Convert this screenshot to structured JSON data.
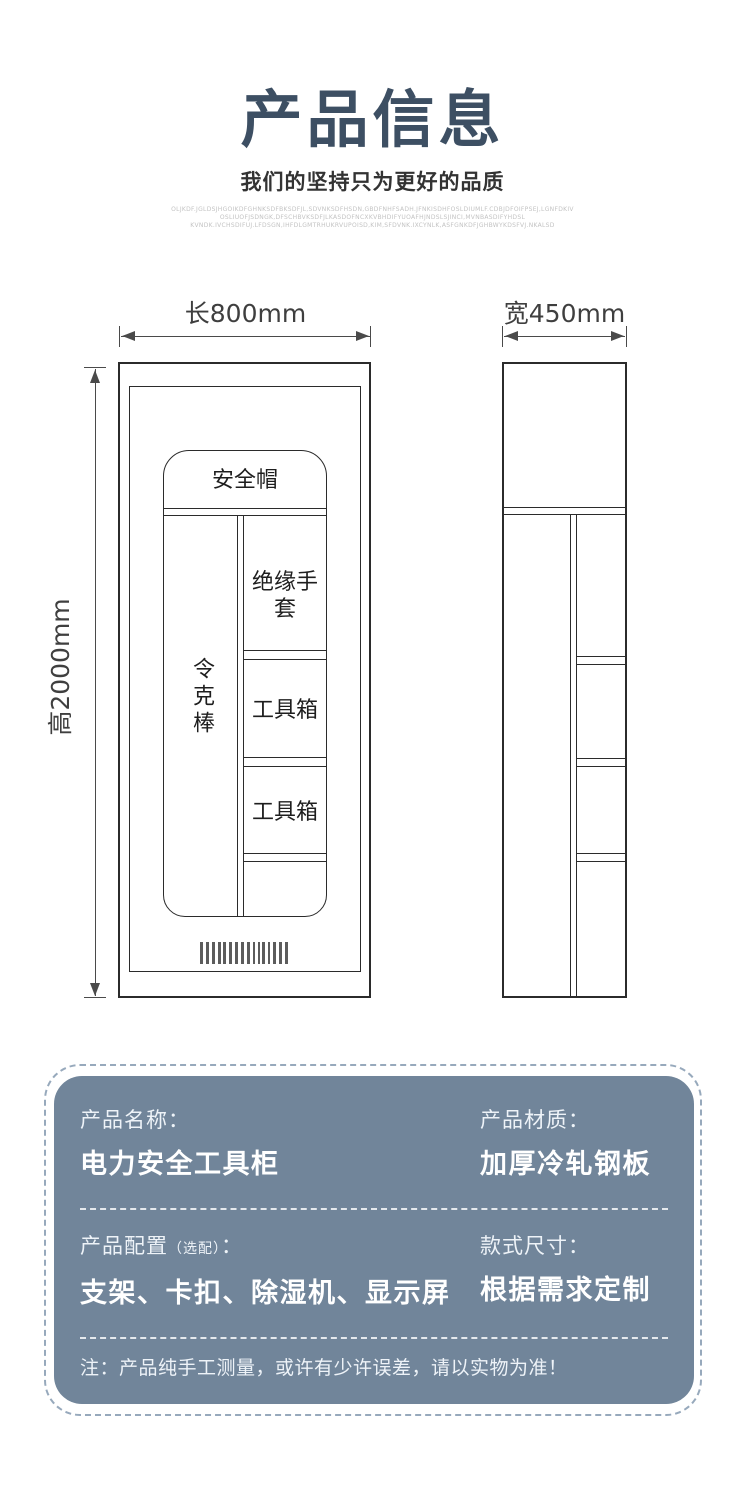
{
  "colors": {
    "title": "#3d4f63",
    "card_bg": "#71859a",
    "line": "#2b2b2b"
  },
  "header": {
    "title": "产品信息",
    "subtitle": "我们的坚持只为更好的品质",
    "fine_print_lines": [
      "OLJKDF.JGLDSJHGOIKDFGHNKSDFBKSDFJL,SDVNKSDFHSDN,GBDFNHFSADH.JFNKISDHFOSLDIUMLF.CDBJDFOIFPSEJ,LGNFDKIV",
      "OSLIUOFJSDNGK,DFSCHBVKSDFJLKASDOFNCXKVBHDIFYUOAFHJNDSLSJINCI,MVNBASDIFYHDSL",
      "KVNDK.IVCHSDIFUJ.LFDSGN,IHFDLGMTRHUKRVUPOISD,KIM,SFDVNK.IXCYNLK,ASFGNKDFJGHBWYKDSFVJ.NKALSD"
    ]
  },
  "diagram": {
    "front_view": {
      "length_label": "长800mm",
      "height_label": "高2000mm",
      "compartments": {
        "helmet": "安全帽",
        "rod": "令克棒",
        "gloves": "绝缘手套",
        "toolbox_top": "工具箱",
        "toolbox_bottom": "工具箱"
      }
    },
    "side_view": {
      "width_label": "宽450mm"
    }
  },
  "info_card": {
    "row1": {
      "left_label": "产品名称：",
      "left_value": "电力安全工具柜",
      "right_label": "产品材质：",
      "right_value": "加厚冷轧钢板"
    },
    "row2": {
      "left_label_main": "产品配置",
      "left_label_paren": "（选配）",
      "left_label_colon": "：",
      "left_value": "支架、卡扣、除湿机、显示屏",
      "right_label": "款式尺寸：",
      "right_value": "根据需求定制"
    },
    "note": "注：产品纯手工测量，或许有少许误差，请以实物为准！"
  }
}
